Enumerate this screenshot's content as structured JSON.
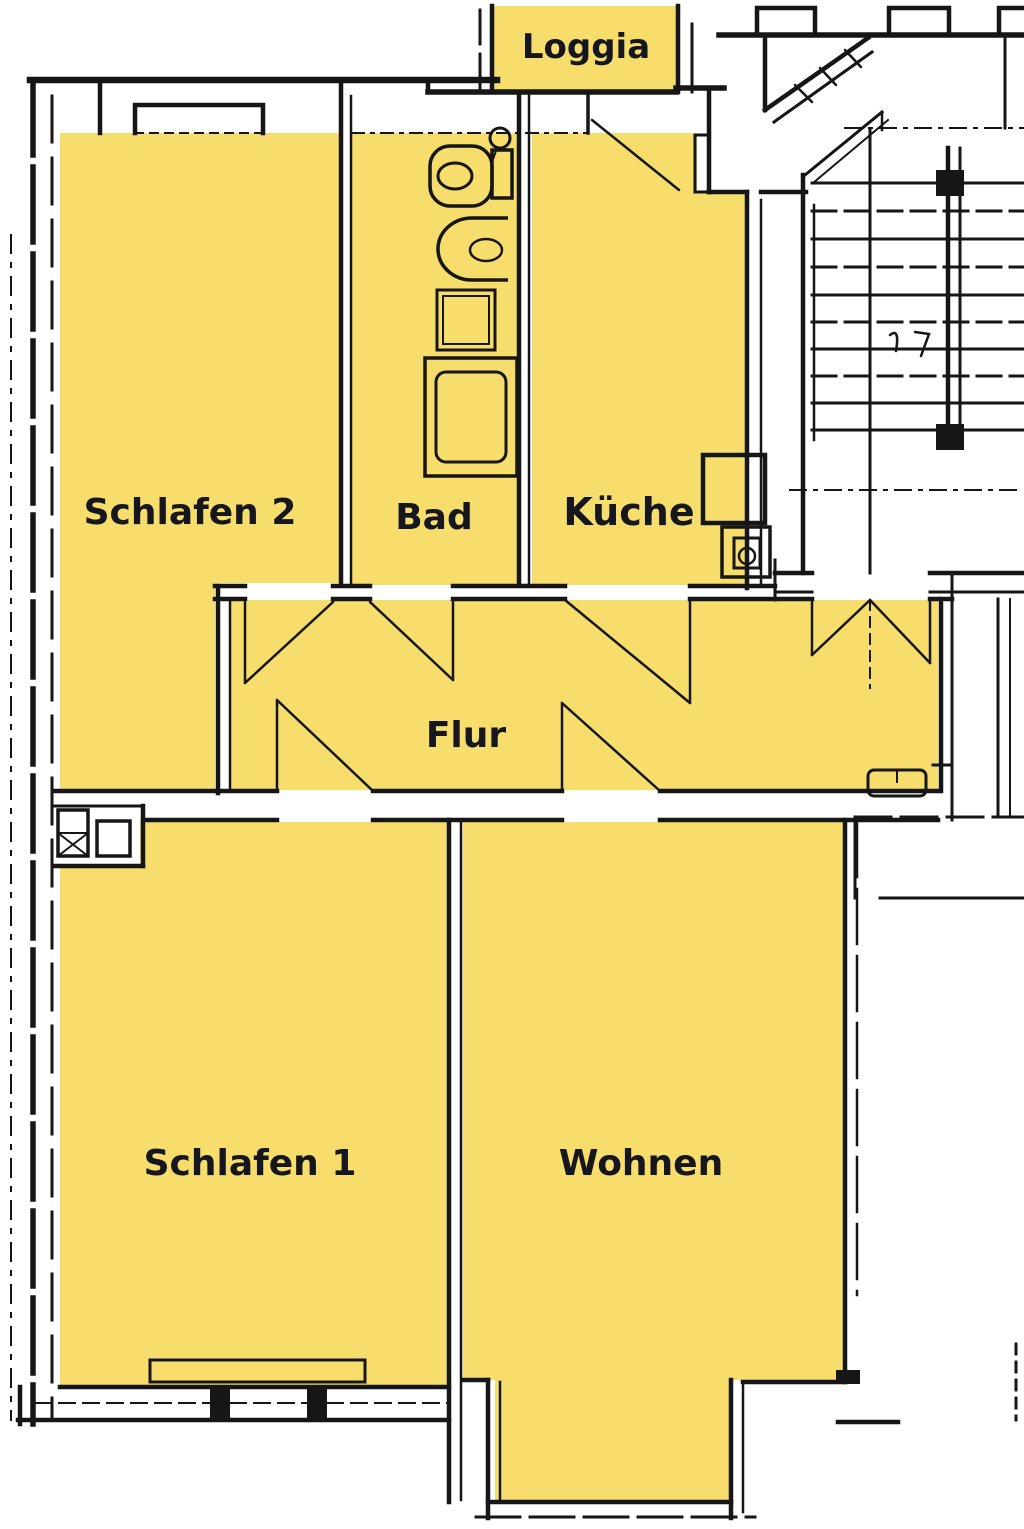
{
  "colors": {
    "room_fill": "#F7DD6B",
    "wall": "#161616",
    "label": "#16161E",
    "background": "#FFFFFF"
  },
  "rooms": [
    {
      "id": "loggia",
      "label": "Loggia"
    },
    {
      "id": "schlafen-2",
      "label": "Schlafen 2"
    },
    {
      "id": "bad",
      "label": "Bad"
    },
    {
      "id": "kueche",
      "label": "Küche"
    },
    {
      "id": "flur",
      "label": "Flur"
    },
    {
      "id": "schlafen-1",
      "label": "Schlafen 1"
    },
    {
      "id": "wohnen",
      "label": "Wohnen"
    }
  ]
}
